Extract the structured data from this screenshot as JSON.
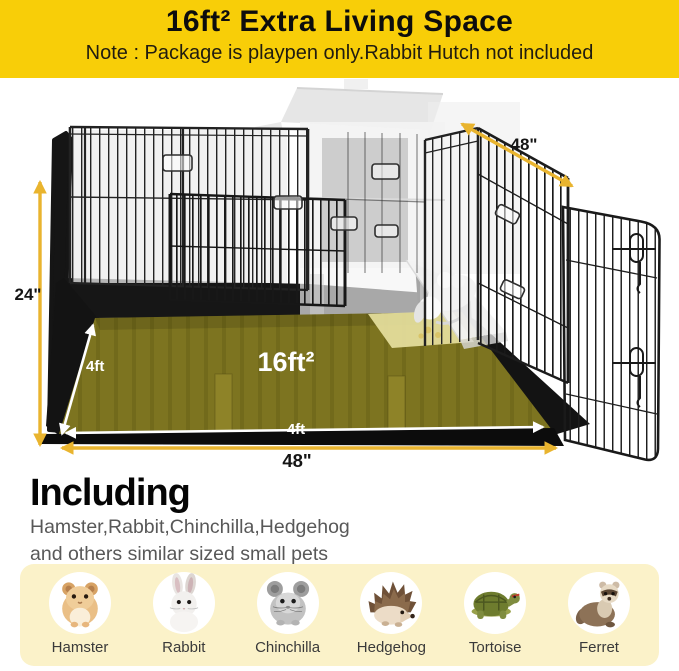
{
  "header": {
    "title": "16ft² Extra Living Space",
    "note": "Note : Package is playpen only.Rabbit Hutch not included"
  },
  "diagram": {
    "dim_top_right": "48\"",
    "dim_left_height": "24\"",
    "dim_mat_depth": "4ft",
    "dim_mat_width": "4ft",
    "dim_bottom_width": "48\"",
    "area_label": "16ft²"
  },
  "including": {
    "heading": "Including",
    "line1": "Hamster,Rabbit,Chinchilla,Hedgehog",
    "line2": "and others similar sized small pets"
  },
  "pets": [
    {
      "name": "Hamster",
      "icon": "hamster-icon"
    },
    {
      "name": "Rabbit",
      "icon": "rabbit-icon"
    },
    {
      "name": "Chinchilla",
      "icon": "chinchilla-icon"
    },
    {
      "name": "Hedgehog",
      "icon": "hedgehog-icon"
    },
    {
      "name": "Tortoise",
      "icon": "tortoise-icon"
    },
    {
      "name": "Ferret",
      "icon": "ferret-icon"
    }
  ],
  "colors": {
    "banner_yellow": "#f8ce08",
    "arrow_gold": "#e9b42e",
    "mat_olive": "#7d7420",
    "panel_cream": "#fbf2c9",
    "wire_black": "#1f1f1f"
  }
}
